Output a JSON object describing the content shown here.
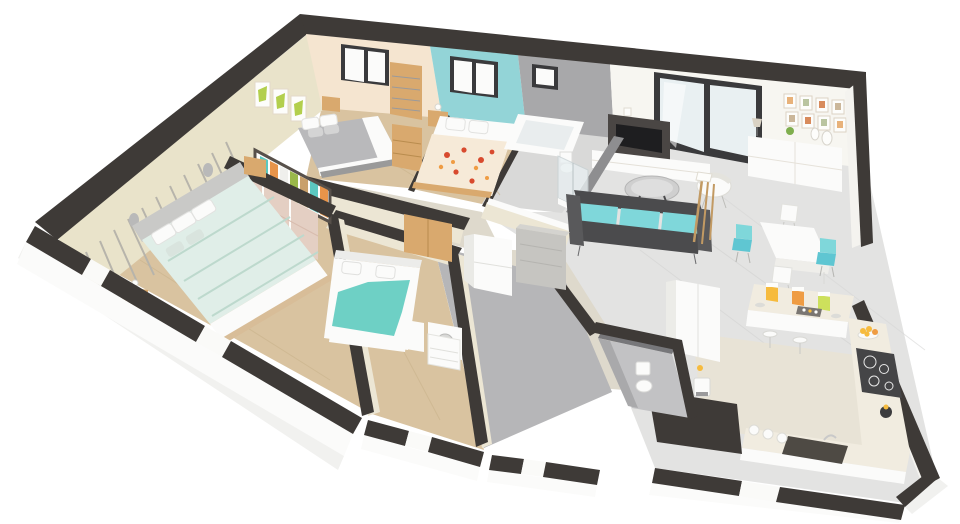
{
  "scene": {
    "type": "3d-floorplan-cutaway-render",
    "view": "aerial-isometric",
    "background": "white",
    "rooms": [
      {
        "id": "master-bedroom",
        "position": "back-left",
        "wall": "peach",
        "floor": "wood",
        "items": [
          "double-bed-gray-white",
          "pillows",
          "nightstand",
          "wooden-dresser",
          "tall-shelf-unit",
          "wall-art-triptych-green",
          "window",
          "open-wardrobe-with-clothes",
          "sliding-door-closet",
          "tall-wooden-wardrobe"
        ]
      },
      {
        "id": "bedroom-blue",
        "position": "back-center",
        "wall": "teal-accent",
        "floor": "wood",
        "items": [
          "double-bed-red-floral-bedding",
          "pillows",
          "nightstand",
          "window"
        ]
      },
      {
        "id": "bathroom",
        "position": "back-center-right",
        "wall": "gray",
        "floor": "gray-tile",
        "items": [
          "bathtub",
          "glass-shower",
          "toilet",
          "small-window"
        ]
      },
      {
        "id": "living-room",
        "position": "right",
        "wall": "white",
        "floor": "light-gray-tile",
        "items": [
          "sliding-glass-door",
          "gallery-picture-frames",
          "wall-shelf",
          "tv-panel",
          "tv",
          "media-cabinet",
          "sideboard-with-decor",
          "round-glass-coffee-table",
          "rattan-armchair",
          "teal-sofa",
          "wooden-floor-lamp"
        ]
      },
      {
        "id": "dining-area",
        "position": "center-right",
        "floor": "light-gray-tile",
        "items": [
          "white-dining-table",
          "teal-chair",
          "teal-chair",
          "white-chair",
          "white-chair"
        ]
      },
      {
        "id": "kitchen",
        "position": "bottom-right",
        "floor": "beige-tile",
        "items": [
          "u-shaped-counter",
          "breakfast-bar",
          "storage-jars-yellow-orange-lime",
          "bar-stools",
          "tall-fridge-cabinet",
          "induction-cooktop",
          "dark-sink",
          "faucet",
          "canisters",
          "fruit-bowl",
          "kettle",
          "coffee-machine"
        ]
      },
      {
        "id": "bedroom-front-left",
        "position": "front-left",
        "wall": "beige-striped-paneling",
        "floor": "wood",
        "items": [
          "double-bed-mint-striped",
          "pillows",
          "gray-headboard",
          "nightstand",
          "nightstand",
          "wall-sconce",
          "wall-sconce"
        ]
      },
      {
        "id": "bedroom-front-middle",
        "position": "front-center",
        "wall": "cream",
        "floor": "wood",
        "items": [
          "double-bed-teal-blanket",
          "pillows",
          "wooden-cabinet",
          "white-dresser"
        ]
      },
      {
        "id": "laundry-utility",
        "position": "center",
        "floor": "gray",
        "items": [
          "refrigerator",
          "concrete-counter",
          "washing-machine",
          "white-cabinet"
        ]
      },
      {
        "id": "wc",
        "position": "front-center-right",
        "wall": "dark-gray",
        "floor": "gray",
        "items": [
          "toilet"
        ]
      },
      {
        "id": "hallway",
        "position": "center-left",
        "floor": "beige-tile",
        "items": []
      }
    ]
  },
  "palette": {
    "bg": "#ffffff",
    "band": "#3e3a37",
    "beige": "#e9e3ca",
    "peach": "#f5e5d0",
    "tealWall": "#93d4d7",
    "grayWall": "#a8a8aa",
    "grayWallDark": "#8e8e90",
    "whiteWall": "#f7f6f1",
    "cream": "#ece6d4",
    "frameDark": "#3a3a3c",
    "glass": "#e9f0f2",
    "woodFloor": "#d9c3a0",
    "woodLine": "#c8b189",
    "tileFloor": "#e3e3e2",
    "grayFloor": "#b6b6b8",
    "kitchenFloor": "#e8e3d6",
    "hallFloor": "#ded9cc",
    "furnWood": "#d9a96e",
    "furnWoodDark": "#c4924f",
    "white": "#fbfbfa",
    "offWhite": "#efeeea",
    "bedGray": "#b9b9bb",
    "mint": "#e0eee8",
    "mintLine": "#bdd9cd",
    "tealBlanket": "#6ed0c5",
    "floralBase": "#f6ead8",
    "red": "#d84a2e",
    "orangeA": "#ef9c43",
    "yellowA": "#f6bb3e",
    "lime": "#cde05c",
    "artGreen": "#b3cf4d",
    "sofaTeal": "#7fd7da",
    "charcoal": "#4b4b4d",
    "charcoal2": "#59595b",
    "counter": "#f1ece0",
    "concrete": "#c6c5c1",
    "cooktop": "#454547",
    "sinkDark": "#4e4a44",
    "rose": "#e4cfc3",
    "stripeGray": "#b7b4ab",
    "grayLight": "#d9d9d8",
    "shadow": "#f1f1ef",
    "wcWall": "#77777a",
    "wcWallLight": "#a9a9ab"
  }
}
